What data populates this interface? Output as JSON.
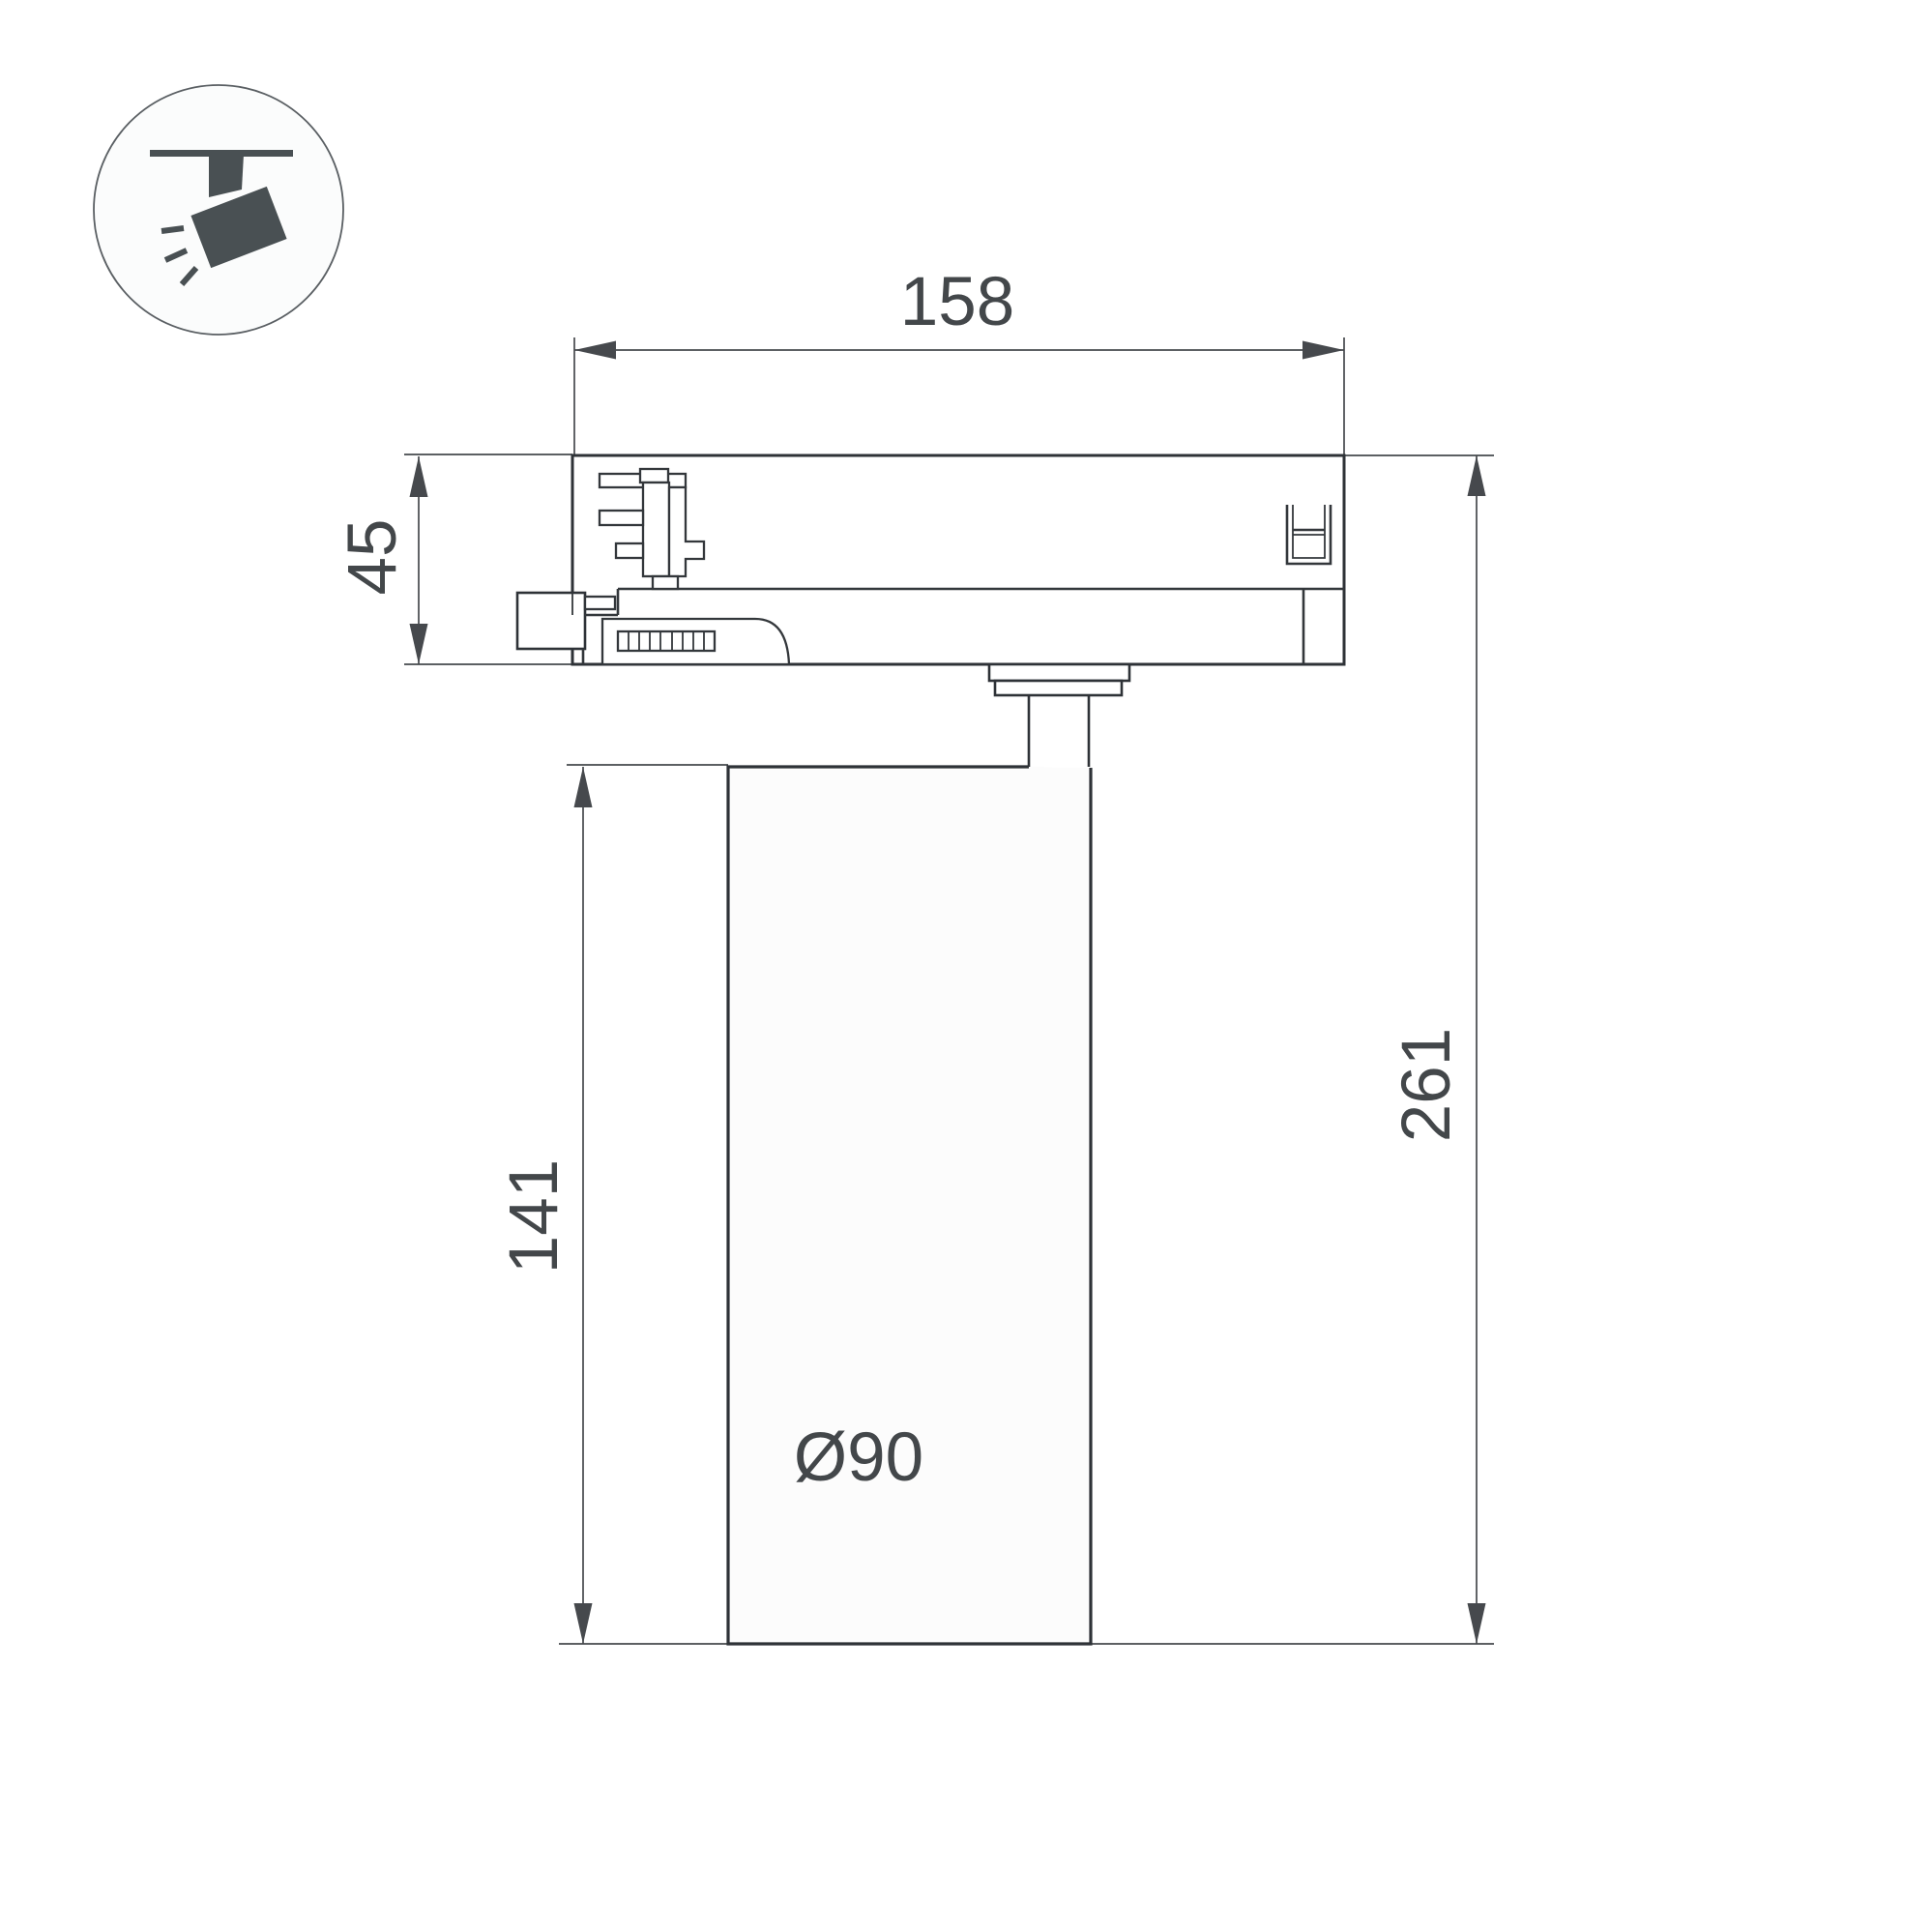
{
  "colors": {
    "bg": "#ffffff",
    "line": "#2e3237",
    "detail": "#33373b",
    "dim": "#46494d",
    "dim-text": "#43474a",
    "icon": "#495053",
    "icon-circle": "#5a5f63"
  },
  "icon": {
    "name": "track-spotlight-icon",
    "description": "track-mounted spotlight pictogram in circle"
  },
  "drawing": {
    "type": "technical-dimension-drawing",
    "object": "track light fixture side view",
    "dimensions": {
      "width_top": {
        "label": "158",
        "value": 158
      },
      "adapter_height": {
        "label": "45",
        "value": 45
      },
      "body_height": {
        "label": "141",
        "value": 141
      },
      "total_height": {
        "label": "261",
        "value": 261
      },
      "body_diameter": {
        "label": "Ø90",
        "value": 90
      }
    }
  }
}
